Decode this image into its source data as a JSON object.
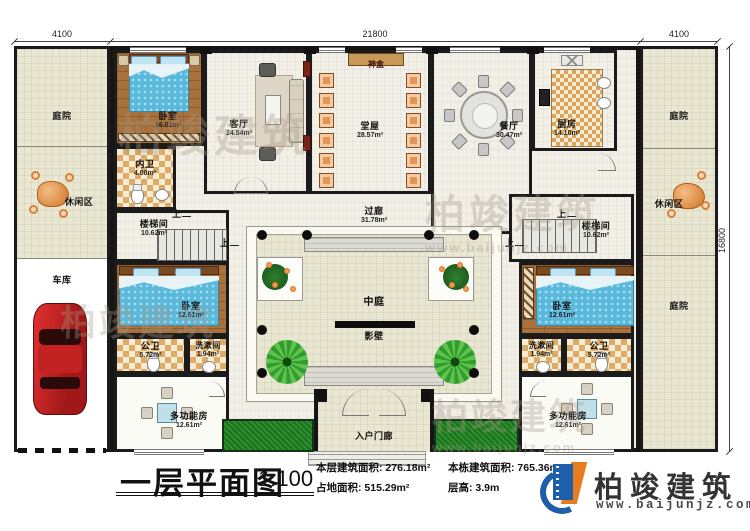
{
  "dims": {
    "top_left": "4100",
    "top_center": "21800",
    "top_right": "4100",
    "right_side": "16800"
  },
  "rooms": {
    "courtyard": {
      "name": "庭院"
    },
    "leisure": {
      "name": "休闲区"
    },
    "garage": {
      "name": "车库"
    },
    "bedroom_main": {
      "name": "卧室",
      "area": "16.01m²"
    },
    "inner_bath": {
      "name": "内卫",
      "area": "4.00m²"
    },
    "living": {
      "name": "客厅",
      "area": "24.54m²"
    },
    "hall": {
      "name": "堂屋",
      "area": "28.57m²"
    },
    "shrine": {
      "name": "神盒"
    },
    "dining": {
      "name": "餐厅",
      "area": "30.47m²"
    },
    "kitchen": {
      "name": "厨房",
      "area": "14.10m²"
    },
    "stair": {
      "name": "楼梯间",
      "area": "10.62m²"
    },
    "corridor": {
      "name": "过廊",
      "area": "31.78m²"
    },
    "atrium": {
      "name": "中庭"
    },
    "screen_wall": {
      "name": "影壁"
    },
    "bedroom_small": {
      "name": "卧室",
      "area": "12.61m²"
    },
    "public_bath": {
      "name": "公卫",
      "area": "5.72m²"
    },
    "wash": {
      "name": "洗漱间",
      "area": "1.94m²"
    },
    "multi": {
      "name": "多功能房",
      "area": "12.61m²"
    },
    "porch": {
      "name": "入户门廊"
    },
    "up": "上"
  },
  "titleblock": {
    "title": "一层平面图",
    "scale": "1:100",
    "stats": [
      {
        "label": "本层建筑面积:",
        "value": "276.18m²"
      },
      {
        "label": "占地面积:",
        "value": "515.29m²"
      },
      {
        "label": "本栋建筑面积:",
        "value": "765.36m²"
      },
      {
        "label": "层高:",
        "value": "3.9m"
      }
    ]
  },
  "logo": {
    "name": "柏竣建筑",
    "url": "www.baijunjz.com"
  },
  "watermark": {
    "name": "柏竣建筑",
    "url": "www.baijunjz.com"
  }
}
